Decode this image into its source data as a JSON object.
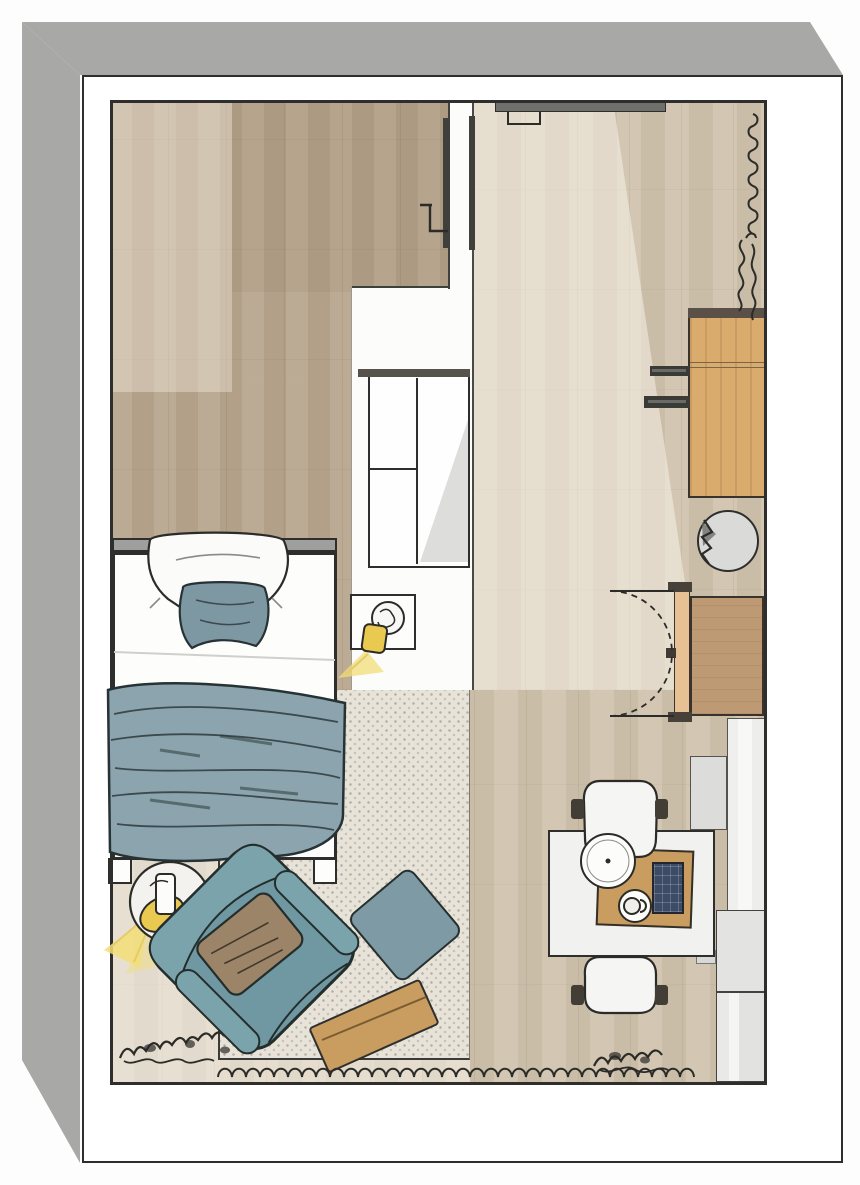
{
  "meta": {
    "type": "floor-plan-rendering",
    "description": "Top-down 3D rendering of a studio bedroom floor plan, sketch style, no visible text"
  },
  "palette": {
    "wall_band": "#a8a8a6",
    "outline": "#2e2e2c",
    "floor_bedroom": "#b9a78e",
    "floor_hall": "#d0c3ad",
    "rug": "#e8e3d9",
    "duvet_teal": "#8ba4ad",
    "armchair_teal": "#6f98a2",
    "ottoman_teal": "#7d9aa5",
    "pillow_teal": "#7e98a3",
    "cushion_brown": "#9c8468",
    "wood_furniture": "#d9ab6c",
    "wardrobe_tan": "#bd9a74",
    "lamp_yellow": "#e9c94f",
    "glow_yellow": "#f3e078",
    "counter_gray": "#e3e3e1",
    "navy_tray": "#3c4c66",
    "white": "#fcfcfa"
  },
  "rooms": {
    "bedroom": {
      "label": "Bedroom area (dark wood floor)"
    },
    "hall": {
      "label": "Hall / living area (light wood floor)"
    }
  },
  "furniture": {
    "bed": {
      "label": "Bed with teal duvet"
    },
    "headboard": {
      "label": "Headboard"
    },
    "pillow_white": {
      "label": "White pillow"
    },
    "pillow_teal": {
      "label": "Teal pillow"
    },
    "nightstand": {
      "label": "Bedside table with lamp"
    },
    "closet": {
      "label": "Built-in white wardrobe"
    },
    "partition_door": {
      "label": "Door in partition wall"
    },
    "entry_door": {
      "label": "Entry door (top wall)"
    },
    "radiator": {
      "label": "Radiator sketch on right wall"
    },
    "plant_right": {
      "label": "Plant sketch (right wall)"
    },
    "desk": {
      "label": "Wooden desk / sideboard"
    },
    "desk_brackets": {
      "label": "Wall brackets at desk"
    },
    "round_table": {
      "label": "Round side table"
    },
    "wardrobe": {
      "label": "Wardrobe with double swing doors"
    },
    "cabinet_white": {
      "label": "Tall white cabinet"
    },
    "cabinet_gray": {
      "label": "Low gray cabinet"
    },
    "counter_a": {
      "label": "Gray counter (upper)"
    },
    "counter_b": {
      "label": "Gray counter (lower)"
    },
    "dining_table": {
      "label": "Dining table"
    },
    "serving_tray": {
      "label": "Wooden serving tray"
    },
    "tablet": {
      "label": "Dark grid tray"
    },
    "plates": {
      "label": "Plates and cup"
    },
    "chair_top": {
      "label": "Dining chair (top)"
    },
    "chair_bottom": {
      "label": "Dining chair (bottom)"
    },
    "rug": {
      "label": "Patterned area rug"
    },
    "armchair": {
      "label": "Teal armchair with brown cushion"
    },
    "ottoman": {
      "label": "Teal ottoman"
    },
    "board": {
      "label": "Wooden board / low table on rug"
    },
    "floor_lamp": {
      "label": "Floor lamp (lit)"
    },
    "plant_bottom_left": {
      "label": "Plant sketch (bottom left)"
    },
    "plant_bottom_right": {
      "label": "Plant sketch (bottom right)"
    },
    "wave_line": {
      "label": "Hand-drawn wave along bottom wall"
    }
  }
}
